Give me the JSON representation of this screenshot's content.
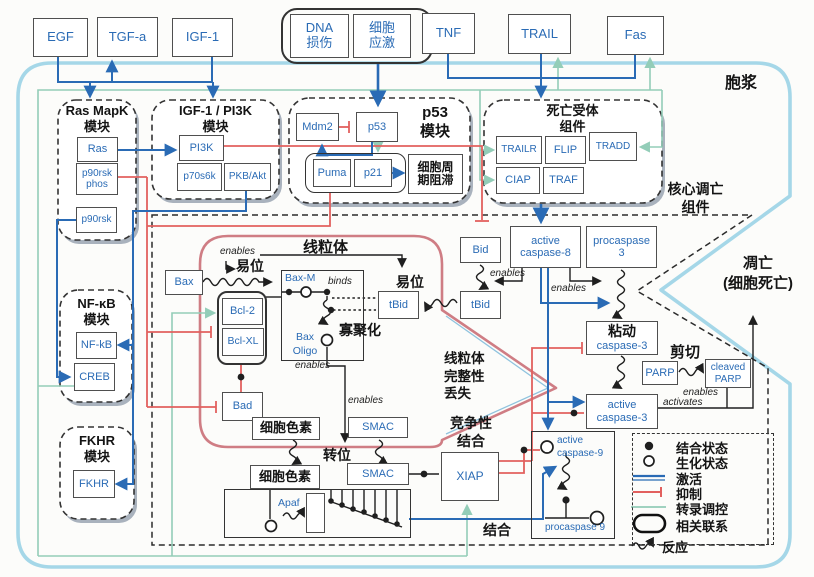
{
  "colors": {
    "activation_blue": "#2a6bb5",
    "inhibition_red": "#e2605e",
    "transcription_green": "#93cdb8",
    "cytoplasm_blue": "#a5d7e8",
    "mito_membrane": "#cf7d84"
  },
  "t": {
    "egf": "EGF",
    "tgfa": "TGF-a",
    "igf1": "IGF-1",
    "dna": "DNA\n损伤",
    "stress": "细胞\n应激",
    "tnf": "TNF",
    "trail": "TRAIL",
    "fas": "Fas",
    "cytoplasm": "胞浆",
    "core": "核心调亡\n组件",
    "apoptosis": "凋亡\n(细胞死亡)",
    "m_ras": "Ras MapK\n模块",
    "m_pi3k": "IGF-1 / PI3K\n模块",
    "m_p53": "p53\n模块",
    "m_death": "死亡受体\n组件",
    "m_nfkb": "NF-κB\n模块",
    "m_fkhr": "FKHR\n模块",
    "ras": "Ras",
    "p90rsk_phos": "p90rsk\nphos",
    "p90rsk": "p90rsk",
    "pi3k": "PI3K",
    "p70s6k": "p70s6k",
    "pkb": "PKB/Akt",
    "mdm2": "Mdm2",
    "p53": "p53",
    "puma": "Puma",
    "p21": "p21",
    "arrest": "细胞周\n期阻滞",
    "trailr": "TRAILR",
    "flip": "FLIP",
    "tradd": "TRADD",
    "ciap": "CIAP",
    "traf": "TRAF",
    "nfkb": "NF-kB",
    "creb": "CREB",
    "fkhr": "FKHR",
    "mito": "线粒体",
    "mito_loss": "线粒体\n完整性\n丢失",
    "bax": "Bax",
    "baxm": "Bax-M",
    "bcl2": "Bcl-2",
    "bclxl": "Bcl-XL",
    "baxoligo": "Bax\nOligo",
    "bad": "Bad",
    "oligo": "寡聚化",
    "yiwei": "易位",
    "yiwei2": "易位",
    "zhuanwei": "转位",
    "bid": "Bid",
    "tbid": "tBid",
    "tbid2": "tBid",
    "casp8": "active\ncaspase-8",
    "procasp3": "procaspase\n3",
    "casp3cn": "粘动",
    "casp3": "caspase-3",
    "acasp3": "active\ncaspase-3",
    "parp": "PARP",
    "cparp": "cleaved\nPARP",
    "jianqie": "剪切",
    "xiap": "XIAP",
    "compete": "竞争性\n结合",
    "jiehe": "结合",
    "acasp9": "active\ncaspase-9",
    "procasp9": "procaspase 9",
    "apaf": "Apaf",
    "cyto": "细胞色素",
    "cyto2": "细胞色素",
    "smac": "SMAC",
    "smac2": "SMAC",
    "enables": "enables",
    "binds": "binds",
    "activates": "activates",
    "lg1": "结合状态",
    "lg2": "生化状态",
    "lg3": "激活",
    "lg4": "抑制",
    "lg5": "转录调控",
    "lg6": "相关联系",
    "lg7": "反应"
  }
}
